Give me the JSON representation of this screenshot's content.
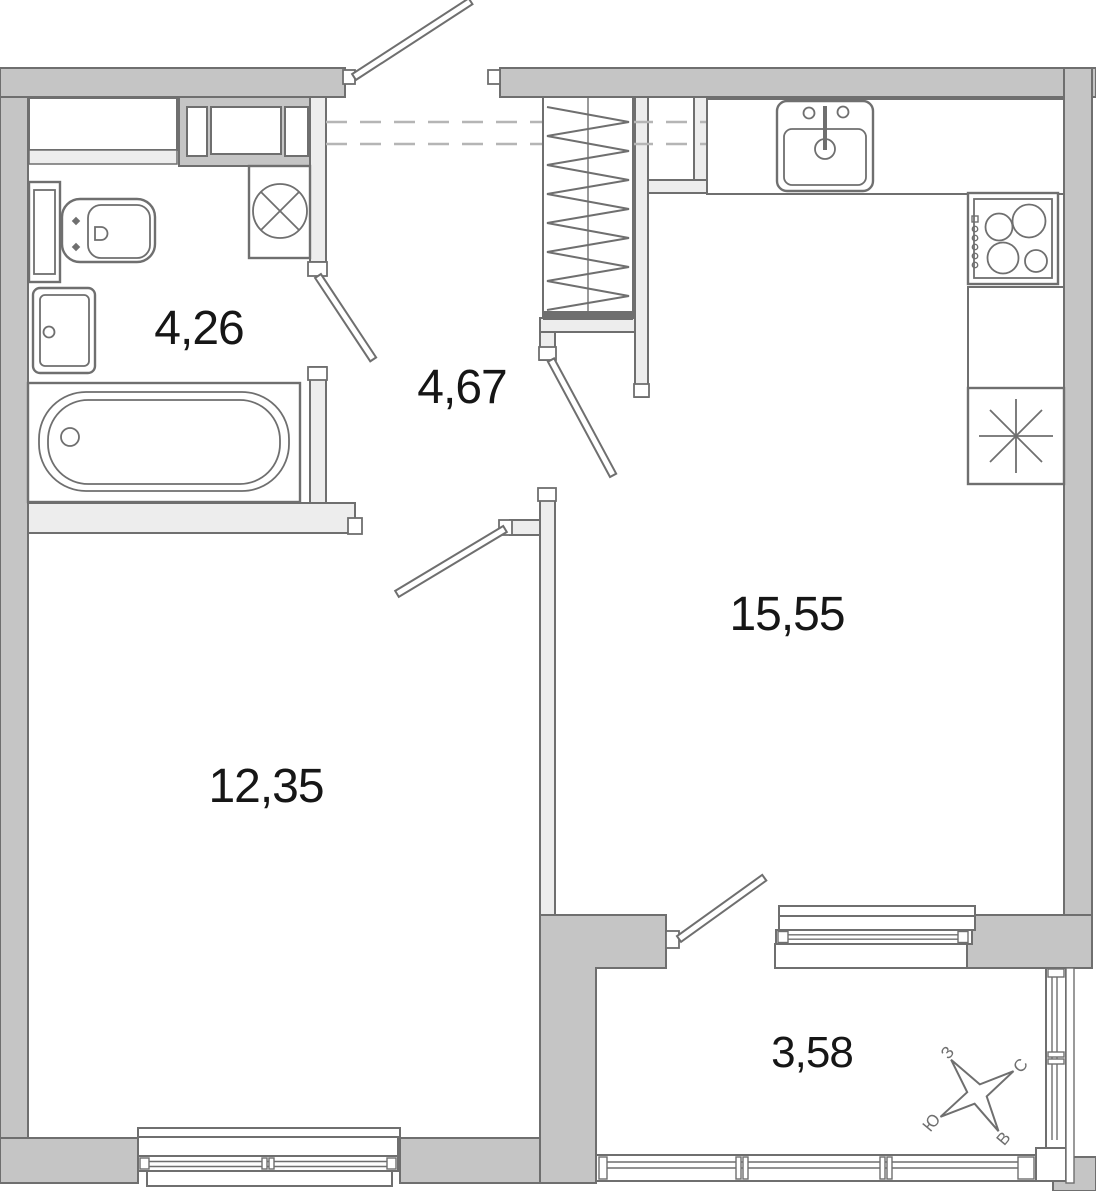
{
  "floorplan": {
    "rooms": [
      {
        "name": "bathroom",
        "area_label": "4,26"
      },
      {
        "name": "hallway",
        "area_label": "4,67"
      },
      {
        "name": "kitchen-living",
        "area_label": "15,55"
      },
      {
        "name": "room",
        "area_label": "12,35"
      },
      {
        "name": "balcony",
        "area_label": "3,58"
      }
    ],
    "compass": {
      "north": "С",
      "east": "В",
      "south": "Ю",
      "west": "З"
    },
    "colors": {
      "outer_wall": "#c5c5c5",
      "inner_wall": "#ededed",
      "line": "#6f6f6f",
      "dash": "#b5b5b5",
      "label": "#161616"
    }
  }
}
